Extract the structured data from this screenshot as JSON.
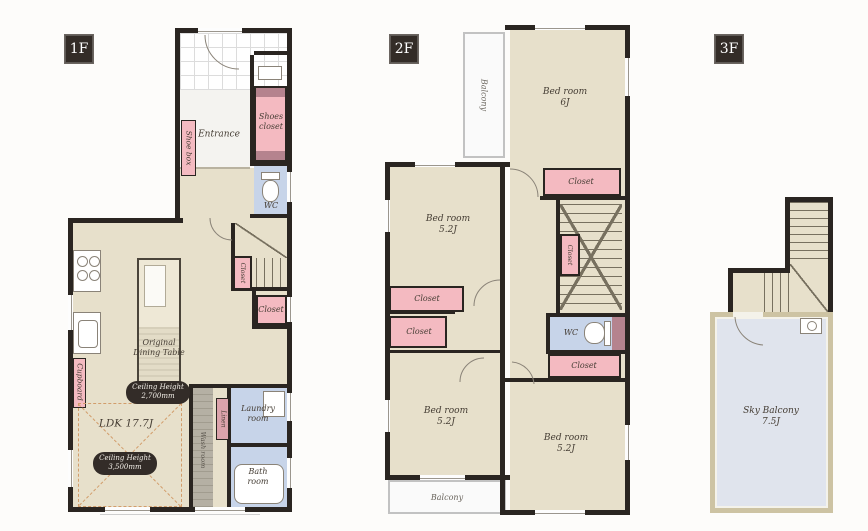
{
  "floors": {
    "f1": {
      "tag": "1F",
      "rooms": {
        "entrance": "Entrance",
        "shoes_closet": "Shoes\ncloset",
        "shoe_box": "Shoe box",
        "wc": "WC",
        "dining_table": "Original\nDining Table",
        "cupboard": "Cupboard",
        "stair_closet": "Closet",
        "closet": "Closet",
        "ldk": "LDK 17.7J",
        "wash_room": "Wash room",
        "linen": "Linen",
        "laundry": "Laundry\nroom",
        "bath": "Bath\nroom"
      },
      "badges": {
        "ceiling_a": "Ceiling Height\n2,700mm",
        "ceiling_b": "Ceiling Height\n3,500mm"
      }
    },
    "f2": {
      "tag": "2F",
      "rooms": {
        "balcony_top": "Balcony",
        "bedroom_6j": "Bed room\n6J",
        "closet_6j": "Closet",
        "bedroom_a": "Bed room\n5.2J",
        "closet_a": "Closet",
        "closet_b": "Closet",
        "stair_closet": "Closet",
        "wc": "WC",
        "closet_c": "Closet",
        "bedroom_b": "Bed room\n5.2J",
        "balcony_bottom": "Balcony",
        "bedroom_c": "Bed room\n5.2J"
      }
    },
    "f3": {
      "tag": "3F",
      "rooms": {
        "sky_balcony": "Sky Balcony\n7.5J"
      }
    }
  },
  "colors": {
    "wall": "#2a2521",
    "floor_beige": "#e7e0cb",
    "storage_pink": "#f4bac1",
    "wet_blue": "#c7d4e9",
    "badge_dark": "#332c28"
  }
}
